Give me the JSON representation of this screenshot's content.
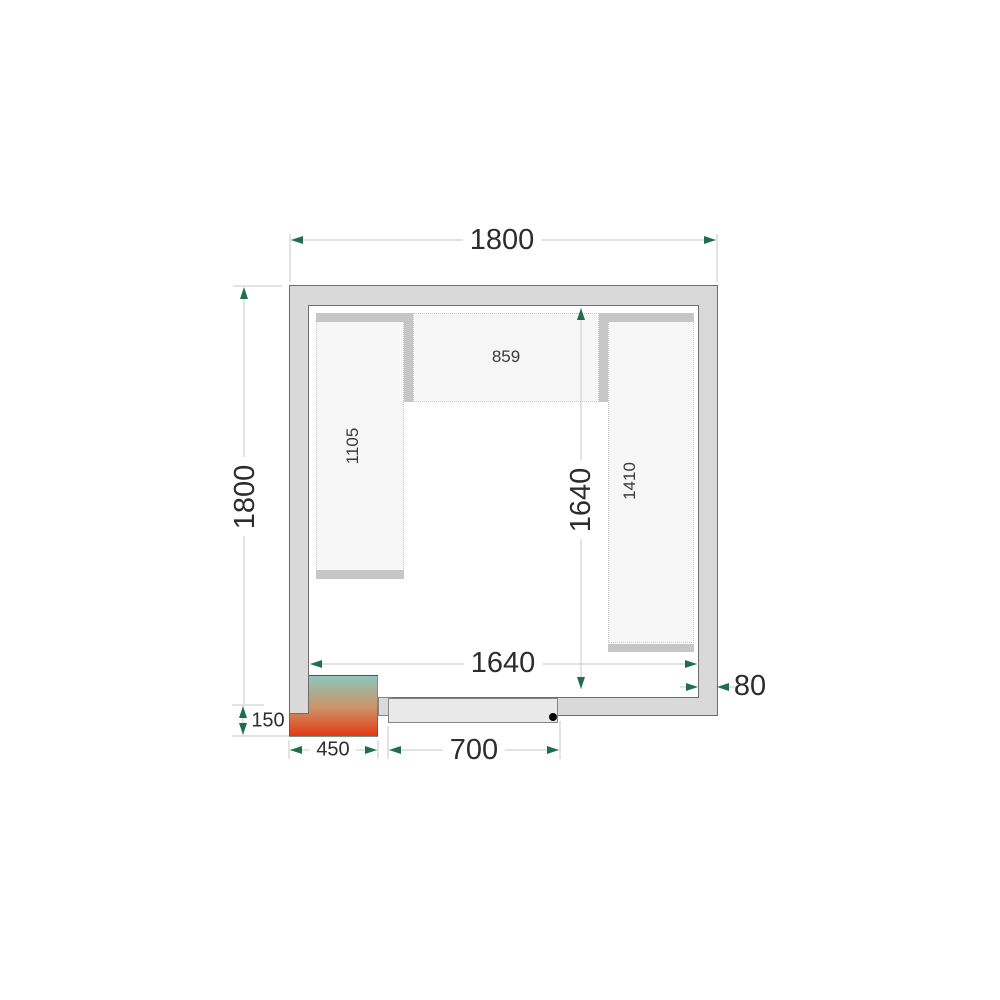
{
  "labels": {
    "overall_width": "1800",
    "overall_depth": "1800",
    "interior_width": "1640",
    "interior_depth": "1640",
    "wall_thickness": "80",
    "door_width": "700",
    "unit_width": "450",
    "unit_offset": "150",
    "shelf_left": "1105",
    "shelf_middle": "859",
    "shelf_right": "1410"
  },
  "colors": {
    "wall_fill": "#d9d9d9",
    "wall_line": "#6d6d6d",
    "shelf_fill": "#f6f6f6",
    "shelf_border": "#c9c9c9",
    "shelf_edge": "#c6c6c6",
    "door_fill": "#e9e9e9",
    "door_line": "#858585",
    "handle": "#000000",
    "dim_line": "#c3cac4",
    "dim_arrow": "#1f6f4c",
    "text": "#2d2d2d",
    "unit_top": "#8cc6ba",
    "unit_mid": "#cd9468",
    "unit_bottom": "#e23a16"
  }
}
